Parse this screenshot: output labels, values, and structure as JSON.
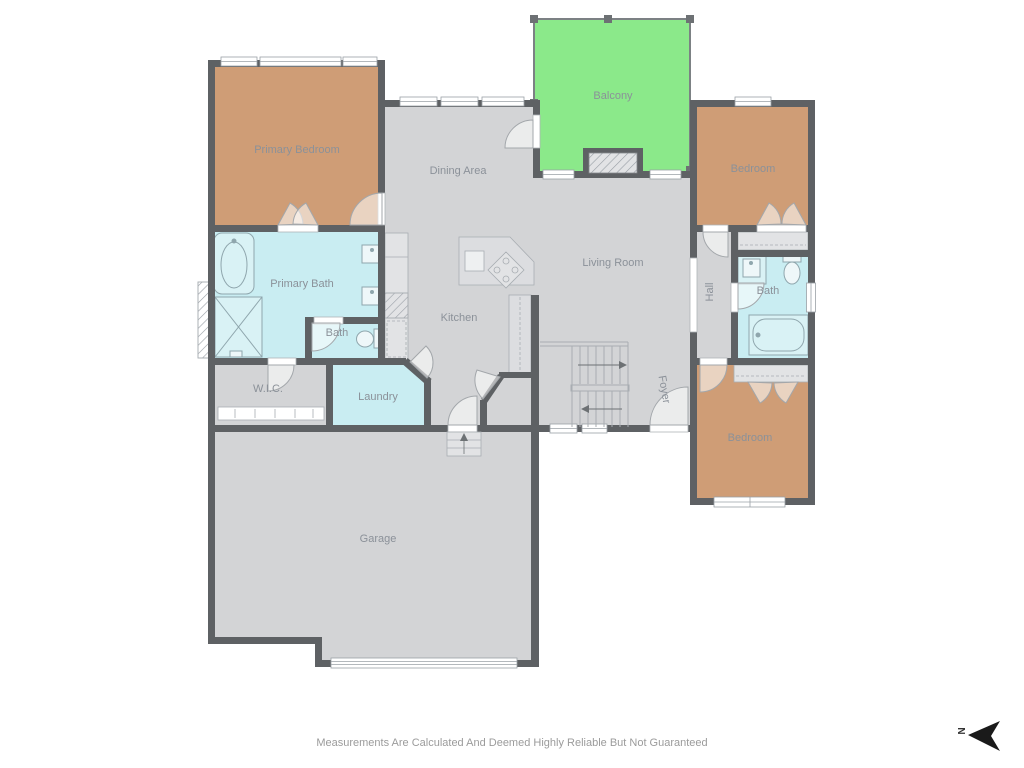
{
  "palette": {
    "wall_color": "#5e6164",
    "floor_color": "#d3d4d6",
    "bedroom_color": "#cf9d76",
    "bath_color": "#c9edf2",
    "balcony_color": "#8be98a",
    "closet_color": "#e2e3e5",
    "fixture_color": "#d9f2f5",
    "label_color": "#8b9199",
    "disclaimer_color": "#9b9b9b",
    "compass_color": "#1a1a1a"
  },
  "rooms": {
    "primary_bedroom": {
      "label": "Primary Bedroom"
    },
    "primary_bath": {
      "label": "Primary Bath"
    },
    "bath_ensuite": {
      "label": "Bath"
    },
    "wic": {
      "label": "W.I.C."
    },
    "laundry": {
      "label": "Laundry"
    },
    "dining": {
      "label": "Dining Area"
    },
    "kitchen": {
      "label": "Kitchen"
    },
    "living": {
      "label": "Living Room"
    },
    "balcony": {
      "label": "Balcony"
    },
    "bedroom_upper": {
      "label": "Bedroom"
    },
    "bedroom_lower": {
      "label": "Bedroom"
    },
    "hall": {
      "label": "Hall"
    },
    "bath_hall": {
      "label": "Bath"
    },
    "foyer": {
      "label": "Foyer"
    },
    "garage": {
      "label": "Garage"
    }
  },
  "footer": {
    "disclaimer": "Measurements Are Calculated And Deemed Highly Reliable But Not Guaranteed"
  },
  "compass": {
    "north_label": "N"
  }
}
